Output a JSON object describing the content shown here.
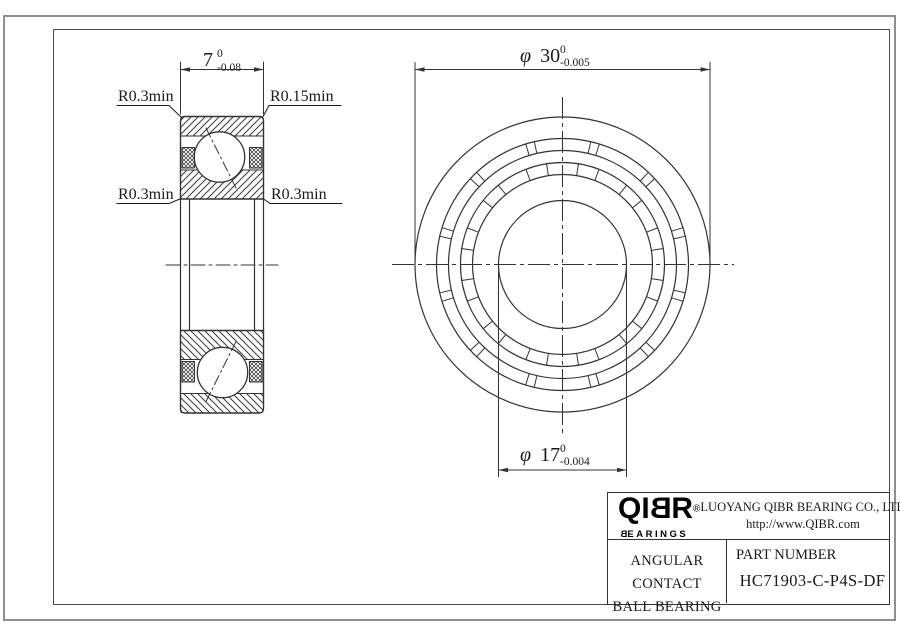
{
  "drawing": {
    "left_view": {
      "dim_width": {
        "value": "7",
        "tol_upper": "0",
        "tol_lower": "-0.08"
      },
      "labels": {
        "top_left": "R0.3min",
        "top_right": "R0.15min",
        "mid_left": "R0.3min",
        "mid_right": "R0.3min"
      }
    },
    "right_view": {
      "dim_outer": {
        "symbol": "φ",
        "value": "30",
        "tol_upper": "0",
        "tol_lower": "-0.005"
      },
      "dim_bore": {
        "symbol": "φ",
        "value": "17",
        "tol_upper": "0",
        "tol_lower": "-0.004"
      }
    }
  },
  "title_block": {
    "logo": {
      "text": "QIBR",
      "registered": "®",
      "sub": "BEARINGS"
    },
    "company": "LUOYANG QIBR BEARING CO., LTD",
    "website": "http://www.QIBR.com",
    "product": {
      "line1": "ANGULAR CONTACT",
      "line2": "BALL BEARING"
    },
    "part": {
      "label": "PART NUMBER",
      "number": "HC71903-C-P4S-DF"
    }
  },
  "colors": {
    "line": "#333333",
    "border_outer": "#8f8f8f",
    "border_inner": "#4a4a4a"
  }
}
